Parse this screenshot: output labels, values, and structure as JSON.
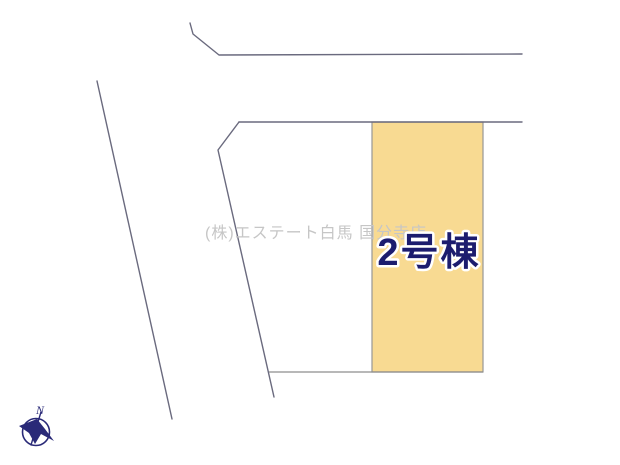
{
  "canvas": {
    "width": 620,
    "height": 465,
    "background": "#ffffff"
  },
  "site_plan": {
    "type": "land-parcel-layout",
    "line_color": "#6a6a7e",
    "boundary_color": "#8d8d8d",
    "unit": {
      "label": "2号棟",
      "fill": "#f8da92",
      "label_color": "#1c1c6e",
      "label_halo": "#ffffff",
      "border_color": "#979797"
    }
  },
  "watermark": {
    "text": "(株)エステート白馬 国分寺店",
    "color": "#c6c6c6"
  },
  "compass": {
    "north_label": "N",
    "color": "#2a2a78"
  }
}
